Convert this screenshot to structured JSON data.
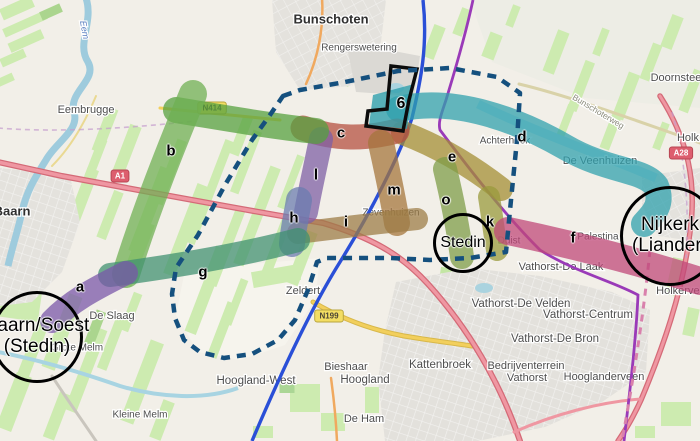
{
  "colors": {
    "cor_a": "#7a57a8",
    "cor_b": "#6fb052",
    "cor_blink": "#55a03e",
    "cor_c": "#b5503f",
    "cor_d": "#2fa0ad",
    "cor_e": "#a38d33",
    "cor_f": "#c04778",
    "cor_g": "#3f9070",
    "cor_h": "#6b7cb0",
    "cor_i": "#9d7c46",
    "cor_k": "#999a3c",
    "cor_l": "#7e5fa5",
    "cor_m": "#a5763c",
    "cor_o": "#7d9c48",
    "boundary": "#15507e",
    "outline": "#0c0c0c",
    "line_blue": "#2a4fd7",
    "line_purple": "#9a3ab8",
    "railway": "#d981ac",
    "motorway_badge": "#dd5e6e",
    "provincial_badge": "#f3dd63"
  },
  "corridor_labels": [
    {
      "label": "a",
      "x": 80,
      "y": 287
    },
    {
      "label": "b",
      "x": 171,
      "y": 151
    },
    {
      "label": "c",
      "x": 341,
      "y": 133
    },
    {
      "label": "d",
      "x": 522,
      "y": 137
    },
    {
      "label": "e",
      "x": 452,
      "y": 157
    },
    {
      "label": "f",
      "x": 573,
      "y": 238
    },
    {
      "label": "g",
      "x": 203,
      "y": 272
    },
    {
      "label": "h",
      "x": 294,
      "y": 218
    },
    {
      "label": "i",
      "x": 346,
      "y": 222
    },
    {
      "label": "k",
      "x": 490,
      "y": 222
    },
    {
      "label": "l",
      "x": 316,
      "y": 175
    },
    {
      "label": "m",
      "x": 394,
      "y": 190
    },
    {
      "label": "o",
      "x": 446,
      "y": 200
    },
    {
      "label": "6",
      "x": 401,
      "y": 104,
      "size": 16
    }
  ],
  "stations": [
    {
      "id": "baarn-soest",
      "lines": [
        "Baarn/Soest",
        "(Stedin)"
      ],
      "x": 37,
      "y": 337,
      "r": 43,
      "font": 19
    },
    {
      "id": "stedin",
      "lines": [
        "Stedin"
      ],
      "x": 463,
      "y": 243,
      "r": 27,
      "font": 16
    },
    {
      "id": "nijkerk",
      "lines": [
        "Nijkerk",
        "(Liander)"
      ],
      "x": 670,
      "y": 236,
      "r": 47,
      "font": 19
    }
  ],
  "place_labels": [
    {
      "text": "Bunschoten",
      "x": 331,
      "y": 20,
      "size": 13,
      "cls": "town"
    },
    {
      "text": "Rengerswetering",
      "x": 359,
      "y": 48,
      "size": 10,
      "cls": "suburb"
    },
    {
      "text": "Doornsteeg",
      "x": 679,
      "y": 78,
      "size": 11,
      "cls": "suburb"
    },
    {
      "text": "Eembrugge",
      "x": 86,
      "y": 110,
      "size": 11,
      "cls": "suburb"
    },
    {
      "text": "Baarn",
      "x": 12,
      "y": 212,
      "size": 13,
      "cls": "town"
    },
    {
      "text": "Holk",
      "x": 688,
      "y": 138,
      "size": 11,
      "cls": "suburb"
    },
    {
      "text": "De Veenhuizen",
      "x": 600,
      "y": 161,
      "size": 11,
      "cls": "suburb"
    },
    {
      "text": "Achterhoek",
      "x": 505,
      "y": 141,
      "size": 10,
      "cls": "suburb"
    },
    {
      "text": "Zevenhuizen",
      "x": 391,
      "y": 213,
      "size": 10,
      "cls": "suburb"
    },
    {
      "text": "Duist",
      "x": 509,
      "y": 241,
      "size": 10,
      "cls": "suburb"
    },
    {
      "text": "Palestina",
      "x": 598,
      "y": 237,
      "size": 10,
      "cls": "suburb"
    },
    {
      "text": "De Slaag",
      "x": 112,
      "y": 316,
      "size": 11,
      "cls": "suburb"
    },
    {
      "text": "Grote Melm",
      "x": 77,
      "y": 348,
      "size": 10,
      "cls": "suburb"
    },
    {
      "text": "Kleine Melm",
      "x": 140,
      "y": 415,
      "size": 10,
      "cls": "suburb"
    },
    {
      "text": "Zeldert",
      "x": 303,
      "y": 291,
      "size": 11,
      "cls": "suburb"
    },
    {
      "text": "Hoogland-West",
      "x": 256,
      "y": 381,
      "size": 11.5,
      "cls": "suburb"
    },
    {
      "text": "Bieshaar",
      "x": 346,
      "y": 367,
      "size": 11,
      "cls": "suburb"
    },
    {
      "text": "Hoogland",
      "x": 365,
      "y": 380,
      "size": 11.5,
      "cls": "suburb"
    },
    {
      "text": "De Ham",
      "x": 364,
      "y": 419,
      "size": 11,
      "cls": "suburb"
    },
    {
      "text": "Kattenbroek",
      "x": 440,
      "y": 365,
      "size": 11.5,
      "cls": "suburb"
    },
    {
      "text": "Vathorst-De Laak",
      "x": 561,
      "y": 267,
      "size": 11,
      "cls": "suburb"
    },
    {
      "text": "Vathorst-De Velden",
      "x": 521,
      "y": 304,
      "size": 11.5,
      "cls": "suburb"
    },
    {
      "text": "Vathorst-Centrum",
      "x": 588,
      "y": 315,
      "size": 11.5,
      "cls": "suburb"
    },
    {
      "text": "Vathorst-De Bron",
      "x": 555,
      "y": 339,
      "size": 11.5,
      "cls": "suburb"
    },
    {
      "text": "Bedrijventerrein",
      "x": 526,
      "y": 366,
      "size": 11,
      "cls": "suburb"
    },
    {
      "text": "Vathorst",
      "x": 527,
      "y": 378,
      "size": 11,
      "cls": "suburb"
    },
    {
      "text": "Hooglanderveen",
      "x": 604,
      "y": 377,
      "size": 11,
      "cls": "suburb"
    },
    {
      "text": "Holkerveen",
      "x": 684,
      "y": 291,
      "size": 11,
      "cls": "suburb"
    },
    {
      "text": "Bunschoterweg",
      "x": 598,
      "y": 112,
      "size": 8.5,
      "cls": "road",
      "rot": 31
    },
    {
      "text": "Eem",
      "x": 84,
      "y": 30,
      "size": 9,
      "cls": "water",
      "rot": 80
    }
  ],
  "road_badges": [
    {
      "text": "A1",
      "x": 120,
      "y": 176,
      "type": "motorway"
    },
    {
      "text": "A28",
      "x": 681,
      "y": 153,
      "type": "motorway"
    },
    {
      "text": "N199",
      "x": 329,
      "y": 316,
      "type": "provincial"
    },
    {
      "text": "N414",
      "x": 212,
      "y": 108,
      "type": "provincial"
    }
  ]
}
